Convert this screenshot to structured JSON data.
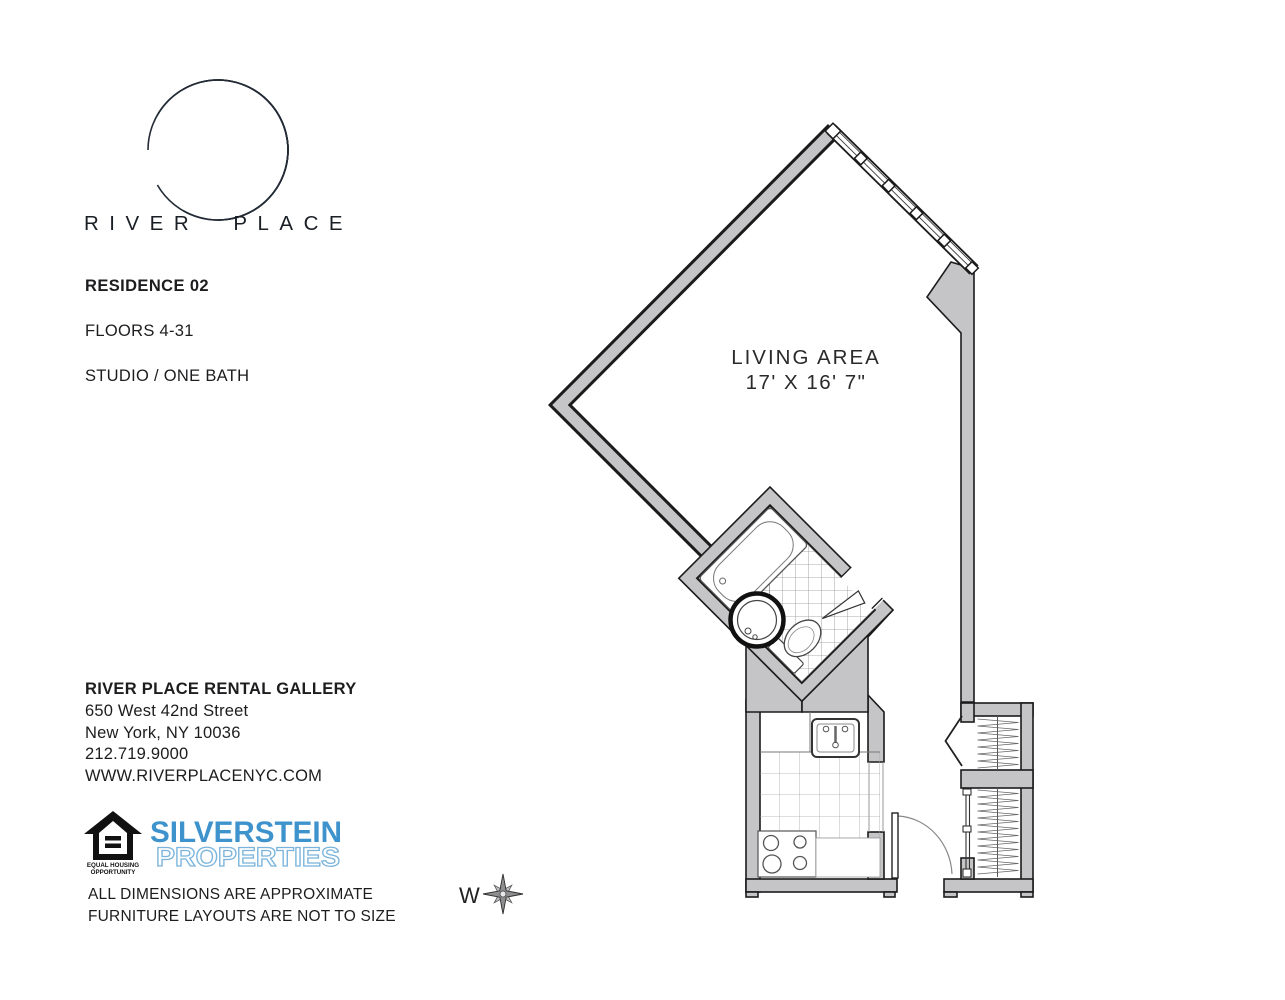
{
  "brand": {
    "title": "RIVER PLACE"
  },
  "unit": {
    "residence": "RESIDENCE 02",
    "floors": "FLOORS 4-31",
    "type": "STUDIO / ONE BATH"
  },
  "plan": {
    "living_area": {
      "label": "LIVING AREA",
      "dimensions": "17' X 16' 7\""
    },
    "compass": {
      "direction": "W"
    }
  },
  "contact": {
    "title": "RIVER PLACE RENTAL GALLERY",
    "address_line1": "650 West 42nd Street",
    "address_line2": "New York, NY 10036",
    "phone": "212.719.9000",
    "website": "WWW.RIVERPLACENYC.COM"
  },
  "logos": {
    "equal_housing": {
      "line1": "EQUAL HOUSING",
      "line2": "OPPORTUNITY"
    },
    "silverstein": {
      "line1": "SILVERSTEIN",
      "line2": "PROPERTIES"
    }
  },
  "disclaimer": {
    "line1": "ALL DIMENSIONS ARE APPROXIMATE",
    "line2": "FURNITURE LAYOUTS ARE NOT TO SIZE"
  },
  "colors": {
    "wall_fill": "#c5c5c7",
    "outline": "#1b1b1b",
    "silverstein_blue": "#3f93cc"
  }
}
